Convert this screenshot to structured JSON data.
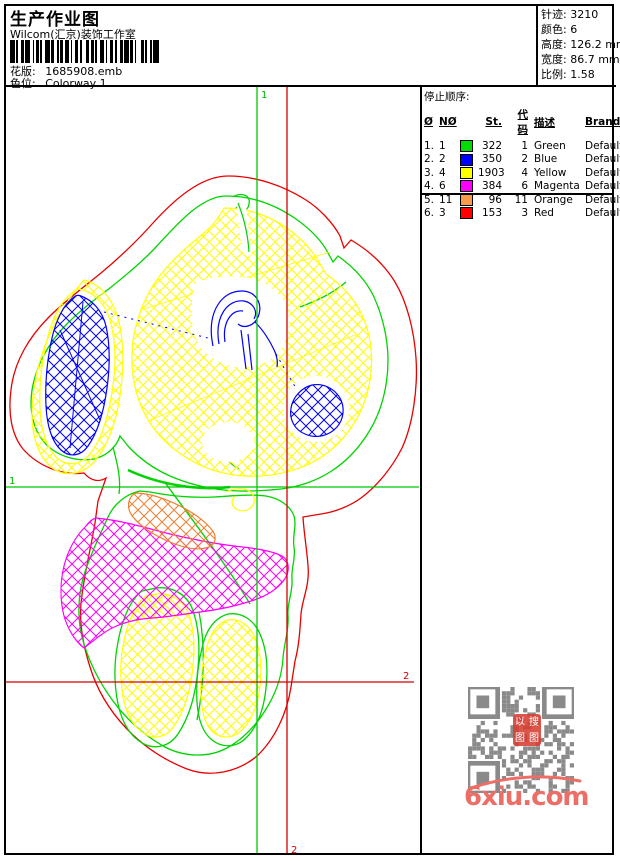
{
  "header": {
    "title": "生产作业图",
    "studio": "Wilcom(汇京)装饰工作室",
    "pattern_label": "花版:",
    "pattern_value": "1685908.emb",
    "colorway_label": "色位:",
    "colorway_value": "Colorway 1"
  },
  "info": {
    "rows": [
      {
        "label": "针迹:",
        "value": "3210"
      },
      {
        "label": "颜色:",
        "value": "6"
      },
      {
        "label": "高度:",
        "value": "126.2 mm"
      },
      {
        "label": "宽度:",
        "value": "86.7 mm"
      },
      {
        "label": "比例:",
        "value": "1.58"
      }
    ]
  },
  "stop_sequence": {
    "title": "停止顺序:",
    "columns": {
      "c0": "Ø",
      "c1": "NØ",
      "c2": "St.",
      "c3": "代码",
      "c4": "描述",
      "c5": "Brand",
      "c6": "元素"
    },
    "rows": [
      {
        "seq": "1.",
        "n": "1",
        "color": "#00DC00",
        "st": "322",
        "code": "1",
        "desc": "Green",
        "brand": "Default",
        "elem": ""
      },
      {
        "seq": "2.",
        "n": "2",
        "color": "#0000FF",
        "st": "350",
        "code": "2",
        "desc": "Blue",
        "brand": "Default",
        "elem": ""
      },
      {
        "seq": "3.",
        "n": "4",
        "color": "#FFFF00",
        "st": "1903",
        "code": "4",
        "desc": "Yellow",
        "brand": "Default",
        "elem": ""
      },
      {
        "seq": "4.",
        "n": "6",
        "color": "#FF00FF",
        "st": "384",
        "code": "6",
        "desc": "Magenta",
        "brand": "Default",
        "elem": ""
      },
      {
        "seq": "5.",
        "n": "11",
        "color": "#F79A4B",
        "st": "96",
        "code": "11",
        "desc": "Orange",
        "brand": "Default",
        "elem": ""
      },
      {
        "seq": "6.",
        "n": "3",
        "color": "#FF0000",
        "st": "153",
        "code": "3",
        "desc": "Red",
        "brand": "Default",
        "elem": ""
      }
    ]
  },
  "markers": {
    "start_top": "1",
    "start_left": "1",
    "end_right": "2",
    "end_bottom": "2"
  },
  "watermark": {
    "site": "6xiu.com",
    "stamp_chars": [
      "以",
      "搜",
      "图",
      "图"
    ]
  },
  "palette": {
    "green": "#00D400",
    "blue": "#0000FF",
    "yellow": "#FFFF00",
    "magenta": "#FF00FF",
    "orange": "#F08washed",
    "red": "#E80000"
  },
  "barcode": {
    "pattern": [
      3,
      1,
      1,
      2,
      2,
      1,
      3,
      2,
      1,
      1,
      2,
      1,
      1,
      2,
      3,
      1,
      2,
      2,
      1,
      1,
      2,
      1,
      3,
      1,
      1,
      2,
      2,
      1,
      1,
      3,
      2,
      1,
      2,
      1,
      1,
      2,
      3,
      1,
      1,
      2,
      2,
      1,
      1,
      2,
      2,
      1,
      3,
      1,
      2,
      1,
      1,
      3,
      2,
      1,
      1,
      2,
      1,
      1,
      4
    ]
  }
}
